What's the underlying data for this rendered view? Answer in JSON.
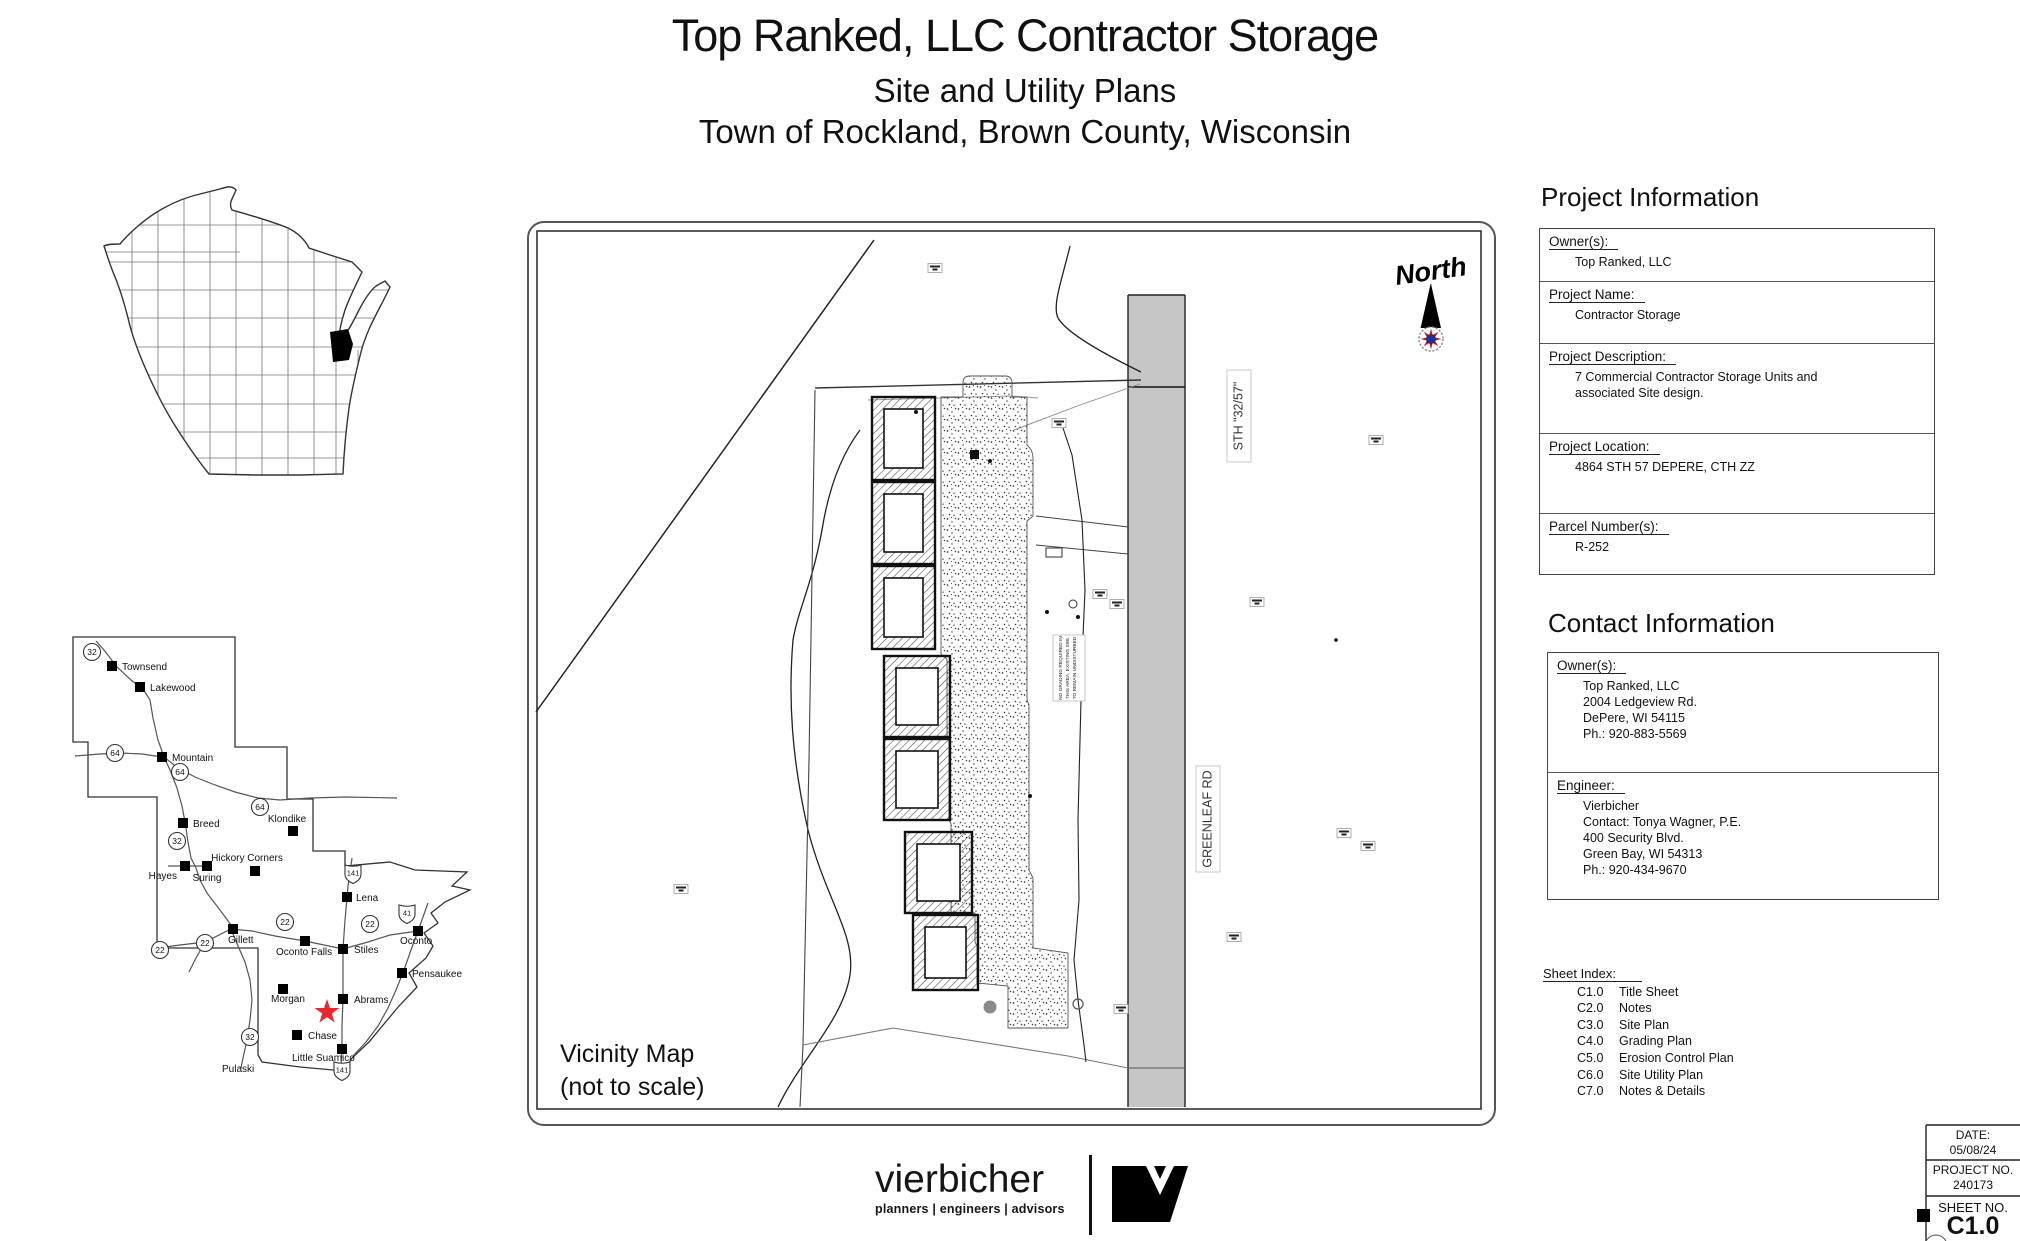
{
  "title": {
    "line1": "Top Ranked, LLC Contractor Storage",
    "line2": "Site and Utility Plans",
    "line3": "Town of Rockland, Brown County, Wisconsin"
  },
  "vicinity": {
    "caption_line1": "Vicinity Map",
    "caption_line2": "(not to scale)",
    "north_label": "North",
    "sth_label": "STH  \"32/57\"",
    "greenleaf_label": "GREENLEAF  RD",
    "note_lines": [
      "NO GRADING REQUIRED IN",
      "THIS AREA, EXISTING SWL",
      "TO REMAIN UNDISTURBED"
    ]
  },
  "project_information": {
    "heading": "Project Information",
    "sections": [
      {
        "label": "Owner(s):",
        "lines": [
          "Top Ranked, LLC"
        ]
      },
      {
        "label": "Project Name:",
        "lines": [
          "Contractor Storage"
        ]
      },
      {
        "label": "Project Description:",
        "lines": [
          "7 Commercial Contractor Storage Units and",
          "associated Site design."
        ]
      },
      {
        "label": "Project Location:",
        "lines": [
          "4864 STH 57 DEPERE, CTH ZZ"
        ]
      },
      {
        "label": "Parcel Number(s):",
        "lines": [
          "R-252"
        ]
      }
    ]
  },
  "contact_information": {
    "heading": "Contact Information",
    "sections": [
      {
        "label": "Owner(s):",
        "lines": [
          "Top Ranked, LLC",
          "2004 Ledgeview Rd.",
          "DePere, WI 54115",
          "Ph.: 920-883-5569"
        ]
      },
      {
        "label": "Engineer:",
        "lines": [
          "Vierbicher",
          "Contact: Tonya Wagner, P.E.",
          "400 Security Blvd.",
          "Green Bay, WI 54313",
          "Ph.: 920-434-9670"
        ]
      }
    ]
  },
  "sheet_index": {
    "heading": "Sheet Index:",
    "items": [
      {
        "number": "C1.0",
        "name": "Title Sheet"
      },
      {
        "number": "C2.0",
        "name": "Notes"
      },
      {
        "number": "C3.0",
        "name": "Site Plan"
      },
      {
        "number": "C4.0",
        "name": "Grading Plan"
      },
      {
        "number": "C5.0",
        "name": "Erosion Control Plan"
      },
      {
        "number": "C6.0",
        "name": "Site Utility Plan"
      },
      {
        "number": "C7.0",
        "name": "Notes & Details"
      }
    ]
  },
  "title_block": {
    "date_label": "DATE:",
    "date": "05/08/24",
    "project_no_label": "PROJECT NO.",
    "project_no": "240173",
    "sheet_no_label": "SHEET NO.",
    "sheet_no": "C1.0"
  },
  "logo": {
    "name": "vierbicher",
    "tagline": "planners | engineers | advisors"
  },
  "colors": {
    "star": "#e8272c",
    "road_gray": "#c6c6c6",
    "rose_red": "#b3202a",
    "rose_blue": "#1f2e9e",
    "county_fill": "#000000"
  },
  "county_map": {
    "towns": [
      {
        "name": "Townsend",
        "mx": 112,
        "my": 666,
        "lx": 122,
        "ly": 670,
        "anchor": "start",
        "marker": true
      },
      {
        "name": "Lakewood",
        "mx": 140,
        "my": 687,
        "lx": 150,
        "ly": 691,
        "anchor": "start",
        "marker": true
      },
      {
        "name": "Mountain",
        "mx": 162,
        "my": 757,
        "lx": 172,
        "ly": 761,
        "anchor": "start",
        "marker": true
      },
      {
        "name": "Breed",
        "mx": 183,
        "my": 823,
        "lx": 193,
        "ly": 827,
        "anchor": "start",
        "marker": true
      },
      {
        "name": "Klondike",
        "mx": 293,
        "my": 831,
        "lx": 287,
        "ly": 822,
        "anchor": "middle",
        "marker": true
      },
      {
        "name": "Hickory Corners",
        "mx": 255,
        "my": 871,
        "lx": 247,
        "ly": 861,
        "anchor": "middle",
        "marker": true
      },
      {
        "name": "Hayes",
        "mx": 185,
        "my": 866,
        "lx": 177,
        "ly": 879,
        "anchor": "end",
        "marker": true
      },
      {
        "name": "Suring",
        "mx": 207,
        "my": 866,
        "lx": 207,
        "ly": 881,
        "anchor": "middle",
        "marker": true
      },
      {
        "name": "Lena",
        "mx": 347,
        "my": 897,
        "lx": 356,
        "ly": 901,
        "anchor": "start",
        "marker": true
      },
      {
        "name": "Gillett",
        "mx": 233,
        "my": 929,
        "lx": 228,
        "ly": 943,
        "anchor": "start",
        "marker": true
      },
      {
        "name": "Oconto Falls",
        "mx": 305,
        "my": 941,
        "lx": 276,
        "ly": 955,
        "anchor": "start",
        "marker": true
      },
      {
        "name": "Stiles",
        "mx": 343,
        "my": 949,
        "lx": 354,
        "ly": 953,
        "anchor": "start",
        "marker": true
      },
      {
        "name": "Oconto",
        "mx": 418,
        "my": 931,
        "lx": 400,
        "ly": 944,
        "anchor": "start",
        "marker": true
      },
      {
        "name": "Pensaukee",
        "mx": 402,
        "my": 973,
        "lx": 412,
        "ly": 977,
        "anchor": "start",
        "marker": true
      },
      {
        "name": "Morgan",
        "mx": 283,
        "my": 989,
        "lx": 271,
        "ly": 1002,
        "anchor": "start",
        "marker": true
      },
      {
        "name": "Abrams",
        "mx": 343,
        "my": 999,
        "lx": 354,
        "ly": 1003,
        "anchor": "start",
        "marker": true
      },
      {
        "name": "Chase",
        "mx": 297,
        "my": 1035,
        "lx": 308,
        "ly": 1039,
        "anchor": "start",
        "marker": true
      },
      {
        "name": "Little Suamico",
        "mx": 342,
        "my": 1049,
        "lx": 292,
        "ly": 1061,
        "anchor": "start",
        "marker": true
      },
      {
        "name": "Pulaski",
        "mx": 0,
        "my": 0,
        "lx": 222,
        "ly": 1072,
        "anchor": "start",
        "marker": false
      }
    ],
    "state_route_markers": [
      {
        "num": "32",
        "x": 92,
        "y": 652
      },
      {
        "num": "64",
        "x": 115,
        "y": 753
      },
      {
        "num": "64",
        "x": 180,
        "y": 772
      },
      {
        "num": "64",
        "x": 260,
        "y": 807
      },
      {
        "num": "32",
        "x": 177,
        "y": 841
      },
      {
        "num": "22",
        "x": 285,
        "y": 922
      },
      {
        "num": "22",
        "x": 370,
        "y": 924
      },
      {
        "num": "22",
        "x": 205,
        "y": 943
      },
      {
        "num": "22",
        "x": 160,
        "y": 950
      },
      {
        "num": "32",
        "x": 250,
        "y": 1037
      }
    ],
    "us_route_markers": [
      {
        "num": "141",
        "x": 353,
        "y": 873
      },
      {
        "num": "41",
        "x": 407,
        "y": 913
      },
      {
        "num": "141",
        "x": 342,
        "y": 1070
      }
    ],
    "star": {
      "x": 327,
      "y": 1012
    }
  }
}
